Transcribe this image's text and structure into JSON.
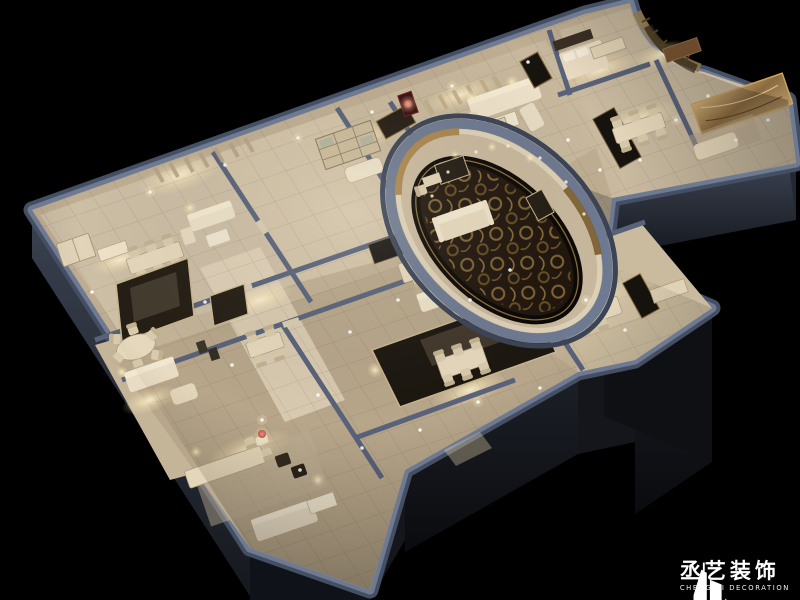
{
  "meta": {
    "image_type": "3d-interior-cutaway-render",
    "description": "Isometric night-time cutaway render of a large multi-room interior (private dining / club floor) in warm champagne tones on a black background, with an oval VIP room with ornate carpet and a curved gallery corner"
  },
  "logo": {
    "name_zh": "丞艺装饰",
    "name_en": "CHENG YI DECORATION"
  },
  "palette": {
    "background": "#000000",
    "wall_rim": "#6e7a92",
    "wall_rim_dark": "#454f63",
    "wall_face": "#2a2f3a",
    "wall_face_dark": "#0e1013",
    "floor_mid": "#bfae92",
    "floor_light": "#e9dcc3",
    "furniture_cream": "#e6d8bc",
    "panel_dark": "#16120d",
    "accent_gold": "#a8834a",
    "accent_red": "#b32020",
    "carpet_dark": "#20160d",
    "glow_warm": "#fff6d6"
  },
  "scene": {
    "style": "warm neutral / champagne interior, night lighting, black void surround",
    "rooms": [
      "executive-office-lounge",
      "bookcase-dining-room",
      "curtain-sofa-lounge",
      "oval-vip-lounge",
      "corridor",
      "round-table-dining-room",
      "mirror-dining-room",
      "bottom-lounge",
      "center-dining-room",
      "lower-right-dining-room",
      "right-wing-dining-room",
      "marble-lounge",
      "curved-gallery-corridor",
      "bedroom-suite"
    ]
  }
}
